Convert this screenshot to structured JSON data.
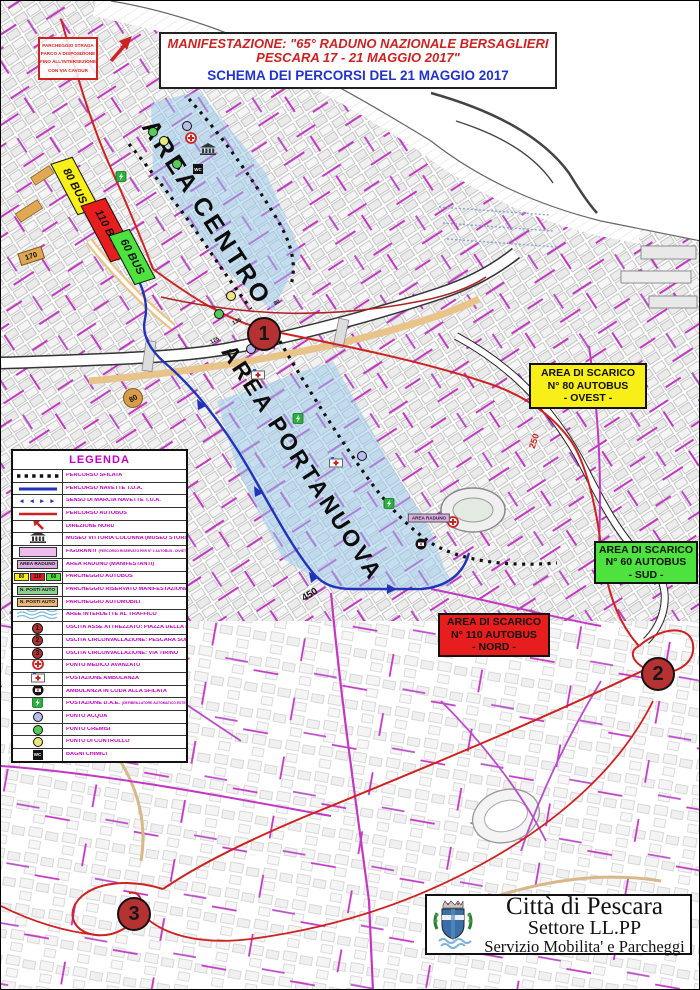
{
  "title_box": {
    "line1": "MANIFESTAZIONE: \"65° RADUNO NAZIONALE BERSAGLIERI",
    "line2": "PESCARA 17 - 21 MAGGIO 2017\"",
    "line3": "SCHEMA DEI PERCORSI DEL 21 MAGGIO 2017"
  },
  "note_box": {
    "lines": [
      "PARCHEGGIO STRADA",
      "PARCO A DISPOSIZIONE",
      "FINO ALL'INTERSEZIONE",
      "CON VIA CAVOUR"
    ]
  },
  "map": {
    "area_labels": [
      {
        "id": "centro",
        "text": "AREA CENTRO",
        "x": 205,
        "y": 212,
        "font": 25
      },
      {
        "id": "portanuova",
        "text": "AREA PORTANUOVA",
        "x": 301,
        "y": 462,
        "font": 23
      }
    ],
    "scarico_boxes": [
      {
        "id": "ovest",
        "lines": [
          "AREA DI SCARICO",
          "N° 80 AUTOBUS",
          "- OVEST -"
        ],
        "bg": "#f8ee18",
        "x": 528,
        "y": 362,
        "w": 118,
        "h": 46
      },
      {
        "id": "sud",
        "lines": [
          "AREA DI SCARICO",
          "N° 60 AUTOBUS",
          "- SUD -"
        ],
        "bg": "#4de23e",
        "x": 593,
        "y": 540,
        "w": 104,
        "h": 43
      },
      {
        "id": "nord",
        "lines": [
          "AREA DI SCARICO",
          "N° 110 AUTOBUS",
          "- NORD -"
        ],
        "bg": "#e81e1e",
        "x": 437,
        "y": 612,
        "w": 112,
        "h": 44
      }
    ],
    "bus_parks": [
      {
        "label": "80 BUS",
        "bg": "#f8ee18",
        "x": 74,
        "y": 185,
        "w": 58,
        "h": 23
      },
      {
        "label": "110 BUS",
        "bg": "#e81e1e",
        "x": 107,
        "y": 229,
        "w": 64,
        "h": 26
      },
      {
        "label": "60 BUS",
        "bg": "#4de23e",
        "x": 131,
        "y": 256,
        "w": 56,
        "h": 22
      }
    ],
    "exit_markers": [
      {
        "number": "1",
        "x": 263,
        "y": 333
      },
      {
        "number": "2",
        "x": 657,
        "y": 673
      },
      {
        "number": "3",
        "x": 133,
        "y": 913
      }
    ],
    "parking_counts": [
      {
        "text": "170",
        "x": 30,
        "y": 255,
        "rotate": -18,
        "style": "tan-tag"
      },
      {
        "text": "80",
        "x": 132,
        "y": 397,
        "rotate": -30,
        "style": "tan-circle"
      },
      {
        "text": "450",
        "x": 309,
        "y": 594,
        "rotate": -32,
        "style": "plain"
      },
      {
        "text": "250",
        "x": 533,
        "y": 440,
        "rotate": -72,
        "style": "plain-red"
      },
      {
        "text": "135",
        "x": 236,
        "y": 321,
        "rotate": -25,
        "style": "tiny"
      },
      {
        "text": "125",
        "x": 214,
        "y": 340,
        "rotate": -25,
        "style": "tiny"
      },
      {
        "text": "190",
        "x": 227,
        "y": 352,
        "rotate": -25,
        "style": "tiny"
      },
      {
        "text": "90",
        "x": 276,
        "y": 302,
        "rotate": -25,
        "style": "tiny"
      }
    ],
    "area_raduno_tag": {
      "text": "AREA RADUNO",
      "x": 428,
      "y": 517
    },
    "icons": [
      {
        "type": "museum",
        "x": 207,
        "y": 150
      },
      {
        "type": "cremisi",
        "x": 152,
        "y": 131
      },
      {
        "type": "cremisi",
        "x": 176,
        "y": 163
      },
      {
        "type": "cremisi",
        "x": 218,
        "y": 313
      },
      {
        "type": "controllo",
        "x": 163,
        "y": 140
      },
      {
        "type": "controllo",
        "x": 230,
        "y": 295
      },
      {
        "type": "acqua",
        "x": 186,
        "y": 125
      },
      {
        "type": "acqua",
        "x": 361,
        "y": 455
      },
      {
        "type": "acqua",
        "x": 250,
        "y": 348
      },
      {
        "type": "medico",
        "x": 190,
        "y": 139
      },
      {
        "type": "medico",
        "x": 452,
        "y": 523
      },
      {
        "type": "ambulanza",
        "x": 257,
        "y": 375
      },
      {
        "type": "ambulanza",
        "x": 335,
        "y": 463
      },
      {
        "type": "coda",
        "x": 420,
        "y": 545
      },
      {
        "type": "dae",
        "x": 120,
        "y": 177
      },
      {
        "type": "dae",
        "x": 297,
        "y": 419
      },
      {
        "type": "dae",
        "x": 388,
        "y": 504
      },
      {
        "type": "wc",
        "x": 197,
        "y": 168
      }
    ]
  },
  "legend": {
    "title": "LEGENDA",
    "items": [
      {
        "symbol": "line-dotted",
        "label": "PERCORSO SFILATA"
      },
      {
        "symbol": "line-blue",
        "label": "PERCORSO NAVETTE T.U.A."
      },
      {
        "symbol": "arrows-blue",
        "glyph": "◄ ◄ ► ►",
        "label": "SENSO DI MARCIA NAVETTE T.U.A."
      },
      {
        "symbol": "line-red",
        "label": "PERCORSO AUTOBUS"
      },
      {
        "symbol": "arrow-north",
        "label": "DIREZIONE NORD"
      },
      {
        "symbol": "museum",
        "label": "MUSEO VITTORIA COLONNA (MUSEO STORICO BERSAGLIERI)"
      },
      {
        "symbol": "figuranti",
        "label": "FIGURANTI",
        "sublabel": "(PERCORSO RISERVATO PER N° 3 AUTOBUS - DIVIETO DI FERMATA)"
      },
      {
        "symbol": "area-raduno",
        "symbol_text": "AREA RADUNO",
        "label": "AREA RADUNO (MANIFESTANTI)"
      },
      {
        "symbol": "bus-parks",
        "symbol_texts": [
          "80",
          "110",
          "60"
        ],
        "label": "PARCHEGGIO AUTOBUS"
      },
      {
        "symbol": "posti-green",
        "symbol_text": "N. POSTI AUTO",
        "label": "PARCHEGGIO RISERVATO MANIFESTAZIONE"
      },
      {
        "symbol": "posti-tan",
        "symbol_text": "N. POSTI AUTO",
        "label": "PARCHEGGIO AUTOMOBILI"
      },
      {
        "symbol": "waves",
        "label": "AREE INTERDETTE AL TRAFFICO"
      },
      {
        "symbol": "exit",
        "symbol_text": "1",
        "label": "USCITA ASSE ATTREZZATO: PIAZZA DELLA MARINA"
      },
      {
        "symbol": "exit",
        "symbol_text": "2",
        "label": "USCITA CIRCONVALLAZIONE: PESCARA SUD"
      },
      {
        "symbol": "exit",
        "symbol_text": "3",
        "label": "USCITA CIRCONVALLAZIONE: VIA TIRINO"
      },
      {
        "symbol": "medico",
        "label": "PUNTO MEDICO AVANZATO"
      },
      {
        "symbol": "ambulanza",
        "label": "POSTAZIONE AMBULANZA"
      },
      {
        "symbol": "coda",
        "label": "AMBULANZA IN CODA ALLA SFILATA"
      },
      {
        "symbol": "dae",
        "label": "POSTAZIONE D.A.E.",
        "sublabel": "(DEFIBRILLATORE AUTOMATICO ESTERNO)"
      },
      {
        "symbol": "acqua",
        "label": "PUNTO ACQUA"
      },
      {
        "symbol": "cremisi",
        "label": "PUNTO CREMISI"
      },
      {
        "symbol": "controllo",
        "label": "PUNTO DI CONTROLLO"
      },
      {
        "symbol": "wc",
        "symbol_text": "WC",
        "label": "BAGNI CHIMICI"
      }
    ]
  },
  "footer_box": {
    "line1": "Città di Pescara",
    "line2": "Settore  LL.PP",
    "line3": "Servizio Mobilita' e  Parcheggi"
  },
  "colors": {
    "route_sfilata": "#111111",
    "route_navette": "#2233bb",
    "route_autobus": "#cc2222",
    "street_magenta": "#c238c2",
    "zone_blue": "#96c8ec",
    "exit_circle": "#b63232",
    "legend_text": "#c000c0",
    "parking_tan": "#e0a855"
  }
}
